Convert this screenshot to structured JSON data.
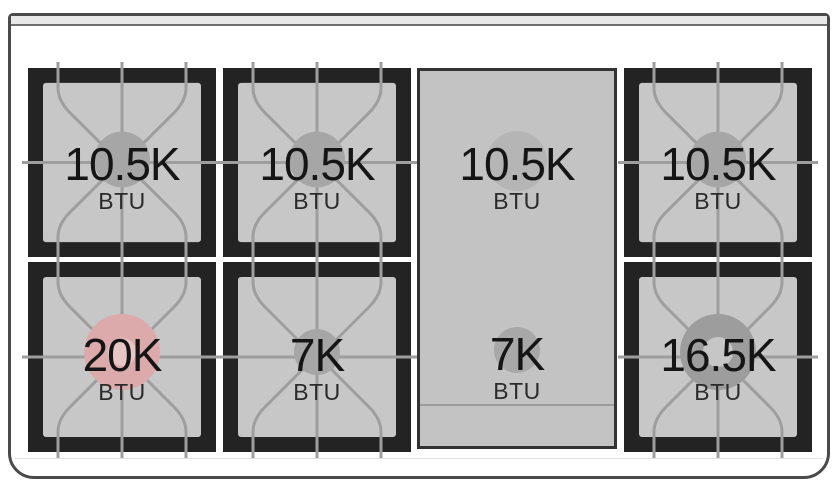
{
  "diagram": {
    "name": "gas range cooktop burner BTU layout",
    "unit_label": "BTU"
  },
  "colors": {
    "grate_black": "#232323",
    "grate_surface": "#c7c7c7",
    "griddle_surface": "#c3c3c3",
    "grate_line": "#9e9e9e",
    "frame_outline": "#4a4a4a",
    "power_burner_pink": "#dcaaaa"
  },
  "burners": {
    "top_left": {
      "value": "10.5K",
      "unit": "BTU",
      "circle": {
        "r": 28,
        "color": "#a6a6a6",
        "inner_r": 0,
        "inner_color": "none"
      }
    },
    "top_center": {
      "value": "10.5K",
      "unit": "BTU",
      "circle": {
        "r": 28,
        "color": "#a6a6a6",
        "inner_r": 0,
        "inner_color": "none"
      }
    },
    "griddle_top": {
      "value": "10.5K",
      "unit": "BTU",
      "circle": {
        "r": 30,
        "color": "#b5b5b5",
        "inner_r": 0,
        "inner_color": "none"
      }
    },
    "top_right": {
      "value": "10.5K",
      "unit": "BTU",
      "circle": {
        "r": 28,
        "color": "#a6a6a6",
        "inner_r": 0,
        "inner_color": "none"
      }
    },
    "bottom_left": {
      "value": "20K",
      "unit": "BTU",
      "circle": {
        "r": 38,
        "color": "#dcaaaa",
        "inner_r": 14,
        "inner_color": "#e9c6c6"
      }
    },
    "bottom_center": {
      "value": "7K",
      "unit": "BTU",
      "circle": {
        "r": 23,
        "color": "#a6a6a6",
        "inner_r": 0,
        "inner_color": "none"
      }
    },
    "griddle_bottom": {
      "value": "7K",
      "unit": "BTU",
      "circle": {
        "r": 23,
        "color": "#a8a8a8",
        "inner_r": 0,
        "inner_color": "none"
      }
    },
    "bottom_right": {
      "value": "16.5K",
      "unit": "BTU",
      "circle": {
        "r": 38,
        "color": "#9d9d9d",
        "inner_r": 15,
        "inner_color": "#c6c6c6"
      }
    }
  }
}
